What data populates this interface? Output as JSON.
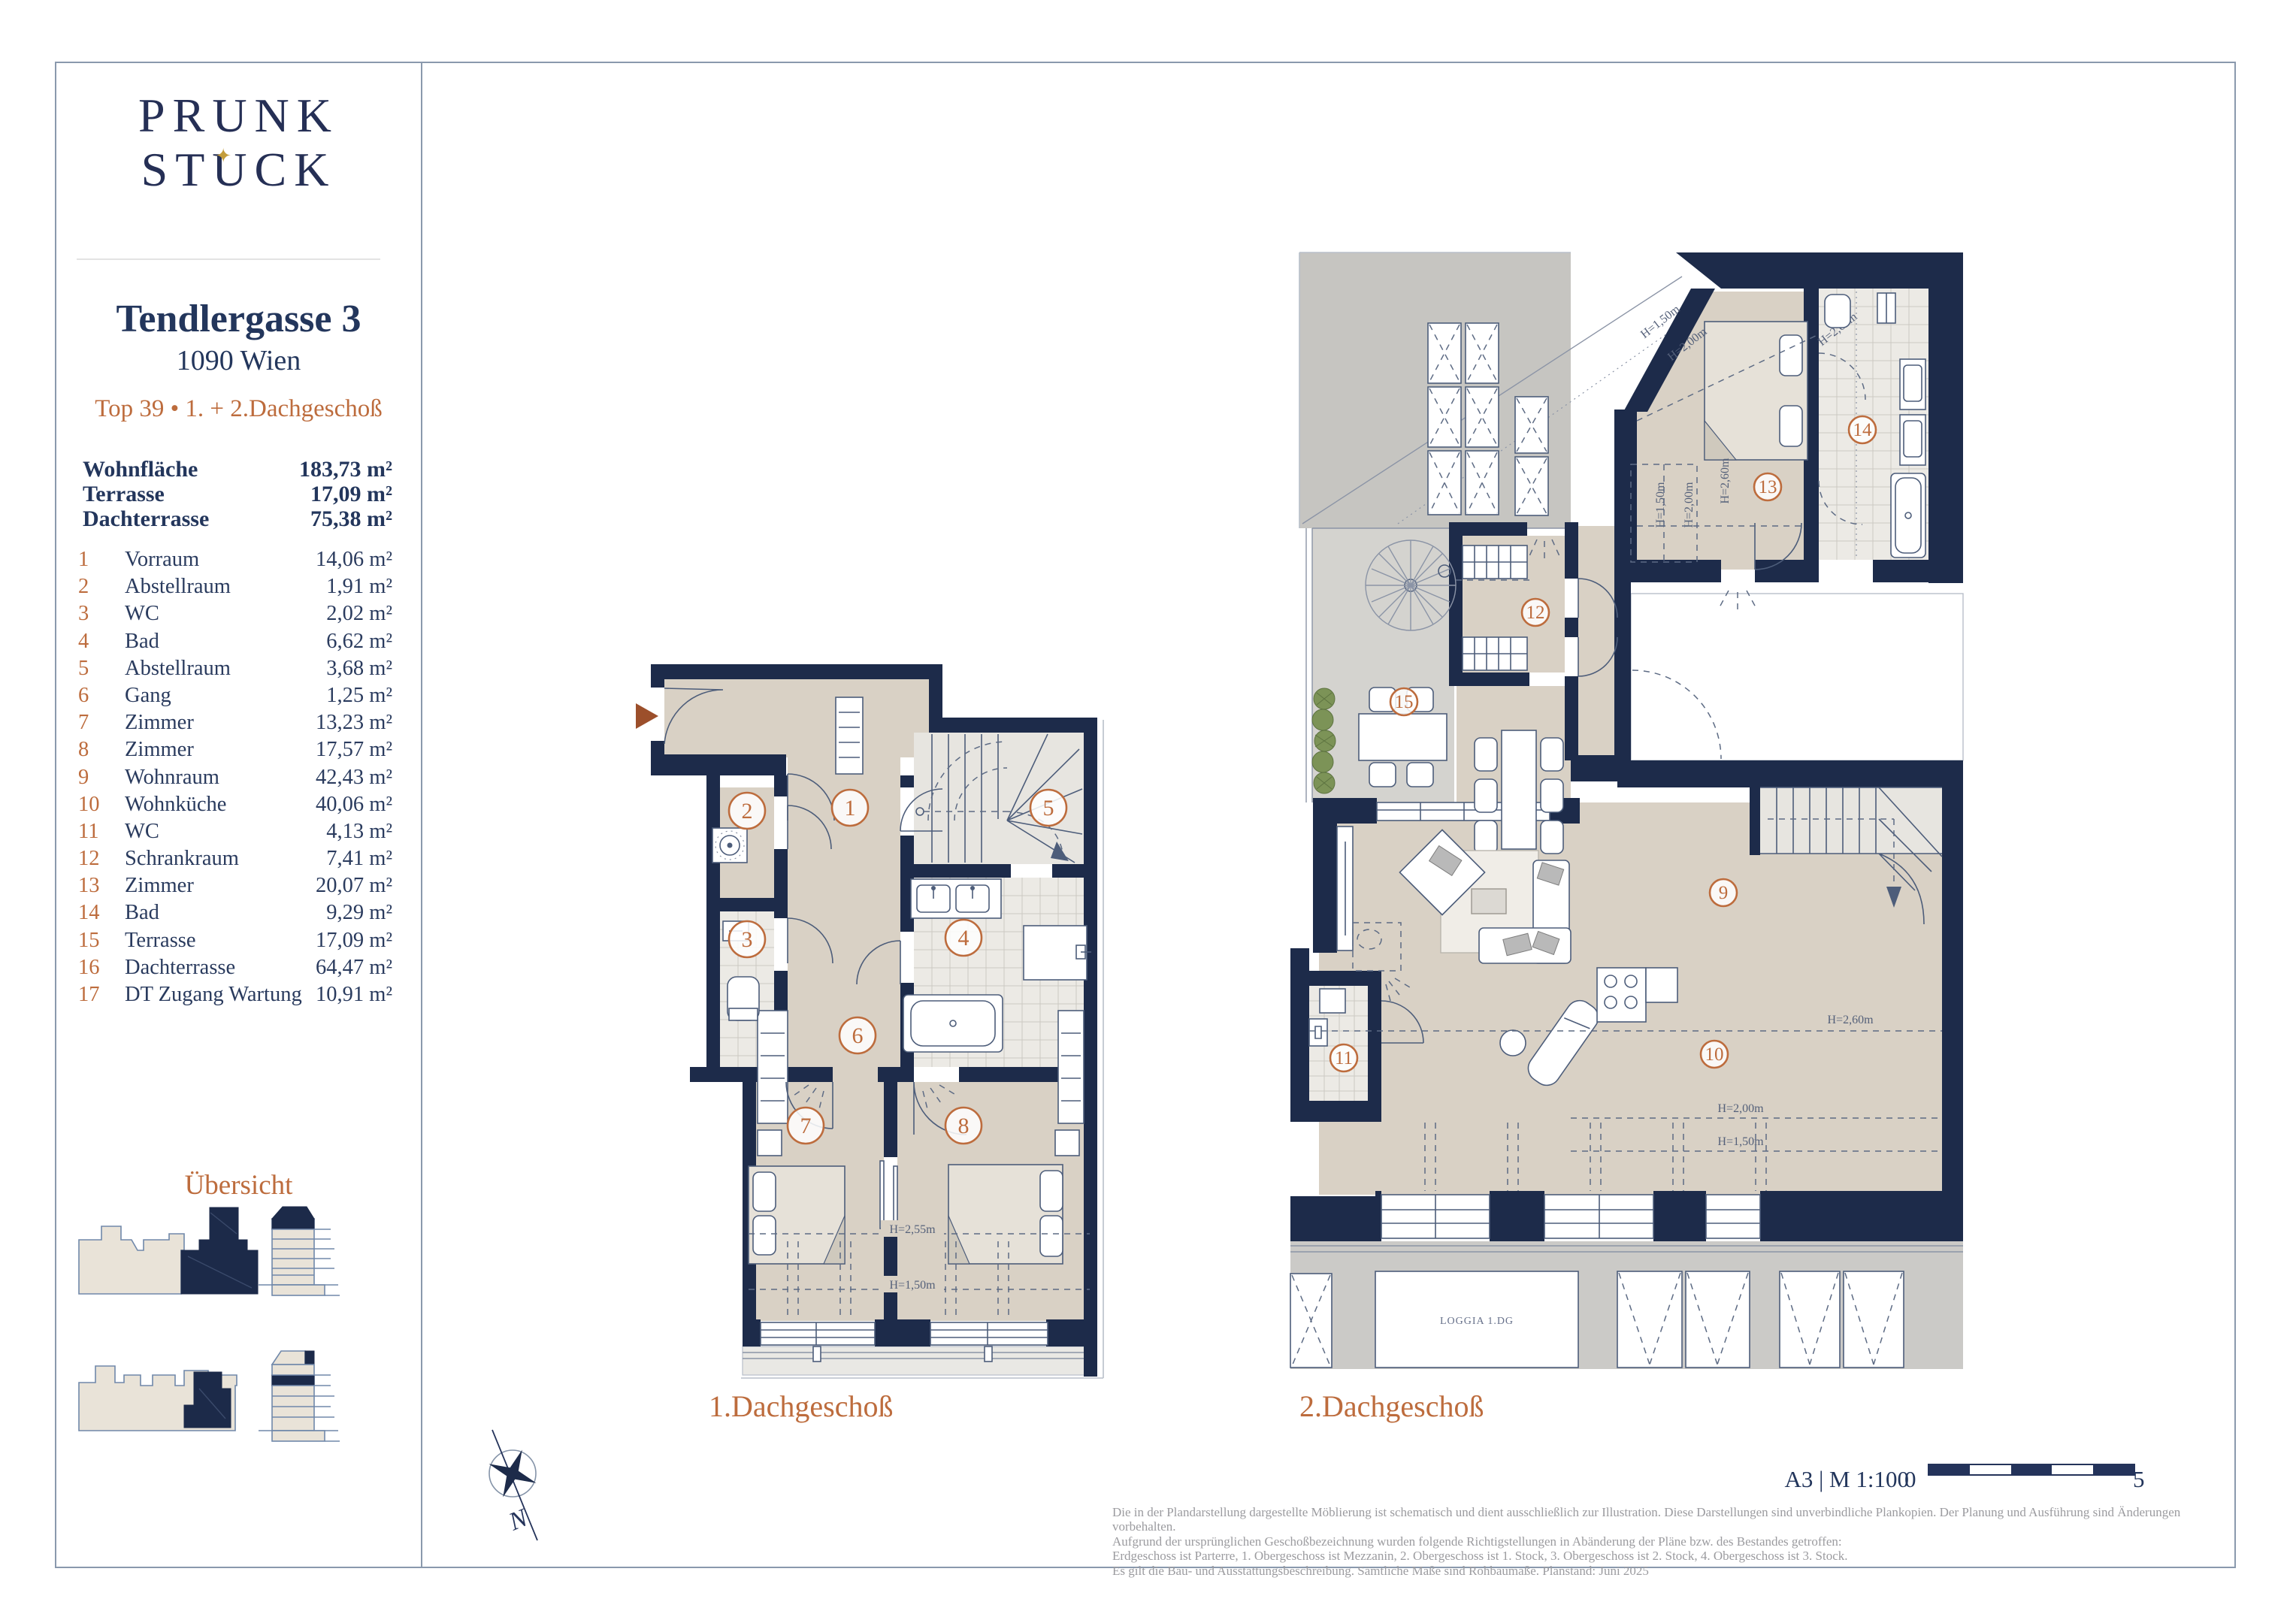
{
  "brand": {
    "line1": "PRUNK",
    "line2_pre": "ST",
    "line2_u": "U",
    "line2_post": "CK",
    "star": "✦"
  },
  "header": {
    "street": "Tendlergasse 3",
    "city": "1090 Wien",
    "unit": "Top 39 • 1. + 2.Dachgeschoß"
  },
  "summary": [
    {
      "label": "Wohnfläche",
      "value": "183,73 m²"
    },
    {
      "label": "Terrasse",
      "value": "17,09 m²"
    },
    {
      "label": "Dachterrasse",
      "value": "75,38 m²"
    }
  ],
  "rooms": [
    {
      "no": "1",
      "name": "Vorraum",
      "area": "14,06 m²"
    },
    {
      "no": "2",
      "name": "Abstellraum",
      "area": "1,91 m²"
    },
    {
      "no": "3",
      "name": "WC",
      "area": "2,02 m²"
    },
    {
      "no": "4",
      "name": "Bad",
      "area": "6,62 m²"
    },
    {
      "no": "5",
      "name": "Abstellraum",
      "area": "3,68 m²"
    },
    {
      "no": "6",
      "name": "Gang",
      "area": "1,25 m²"
    },
    {
      "no": "7",
      "name": "Zimmer",
      "area": "13,23 m²"
    },
    {
      "no": "8",
      "name": "Zimmer",
      "area": "17,57 m²"
    },
    {
      "no": "9",
      "name": "Wohnraum",
      "area": "42,43 m²"
    },
    {
      "no": "10",
      "name": "Wohnküche",
      "area": "40,06 m²"
    },
    {
      "no": "11",
      "name": "WC",
      "area": "4,13 m²"
    },
    {
      "no": "12",
      "name": "Schrankraum",
      "area": "7,41 m²"
    },
    {
      "no": "13",
      "name": "Zimmer",
      "area": "20,07 m²"
    },
    {
      "no": "14",
      "name": "Bad",
      "area": "9,29 m²"
    },
    {
      "no": "15",
      "name": "Terrasse",
      "area": "17,09 m²"
    },
    {
      "no": "16",
      "name": "Dachterrasse",
      "area": "64,47 m²"
    },
    {
      "no": "17",
      "name": "DT Zugang Wartung",
      "area": "10,91 m²"
    }
  ],
  "uebersicht_title": "Übersicht",
  "plan1": {
    "label": "1.Dachgeschoß",
    "h255": "H=2,55m",
    "h150": "H=1,50m"
  },
  "plan2": {
    "label": "2.Dachgeschoß",
    "h260": "H=2,60m",
    "h200": "H=2,00m",
    "h150": "H=1,50m",
    "loggia": "LOGGIA 1.DG"
  },
  "compass": {
    "north": "N"
  },
  "scale": {
    "sheet": "A3 | M 1:100",
    "zero": "0",
    "five": "5"
  },
  "footer": {
    "lines": [
      "Die in der Plandarstellung dargestellte Möblierung ist schematisch und dient ausschließlich zur Illustration. Diese Darstellungen sind unverbindliche Plankopien. Der Planung und Ausführung sind Änderungen vorbehalten.",
      "Aufgrund der ursprünglichen Geschoßbezeichnung wurden folgende Richtigstellungen in Abänderung der Pläne bzw. des Bestandes getroffen:",
      "Erdgeschoss ist Parterre, 1. Obergeschoss ist Mezzanin, 2. Obergeschoss ist 1. Stock, 3. Obergeschoss ist 2. Stock, 4. Obergeschoss ist 3. Stock.",
      "Es gilt die Bau- und Ausstattungsbeschreibung. Sämtliche Maße sind Rohbaumaße. Planstand: Juni 2025"
    ]
  }
}
